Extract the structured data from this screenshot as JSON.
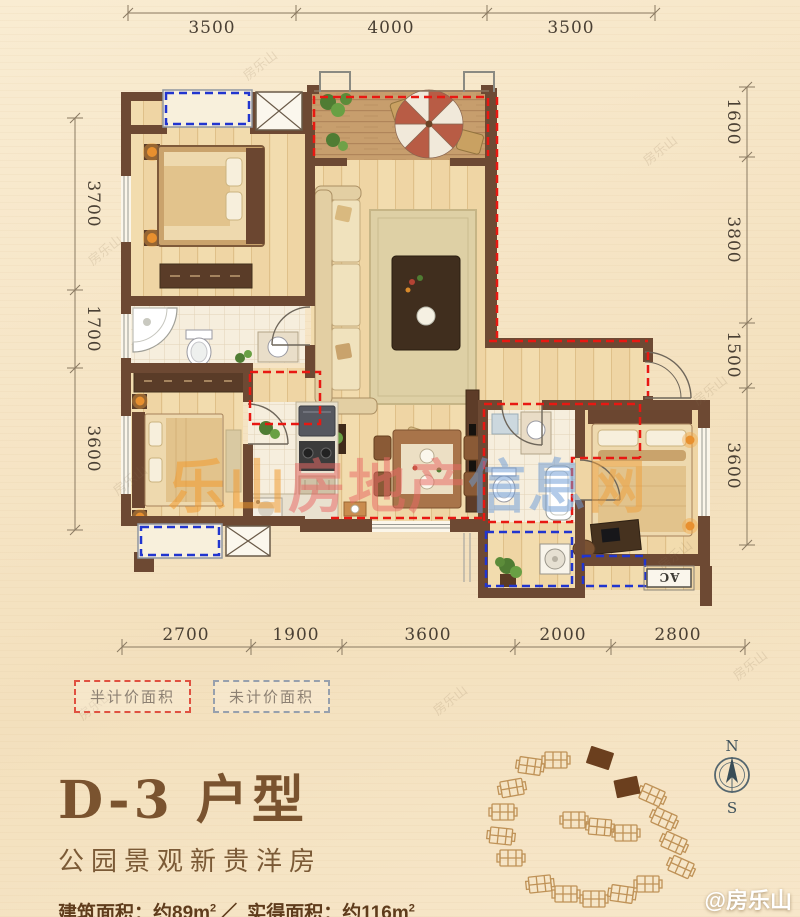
{
  "theme": {
    "background": "#f6e5c6",
    "wall_color": "#6d4933",
    "half_priced_dash": "#e81812",
    "unpriced_dash": "#2135cf",
    "title_brown": "#7a532f",
    "watermark_orange": "#f2992b",
    "watermark_red": "#e96a66",
    "watermark_blue": "#6f9dd6"
  },
  "dimensions": {
    "top": [
      "3500",
      "4000",
      "3500"
    ],
    "left": [
      "3700",
      "1700",
      "3600"
    ],
    "right": [
      "1600",
      "3800",
      "1500",
      "3600"
    ],
    "bottom": [
      "2700",
      "1900",
      "3600",
      "2000",
      "2800"
    ]
  },
  "legend": {
    "items": [
      {
        "label": "半计价面积"
      },
      {
        "label": "未计价面积"
      }
    ]
  },
  "plan": {
    "ac_label": "AC"
  },
  "compass": {
    "north": "N",
    "south": "S"
  },
  "watermark": {
    "center_parts": [
      {
        "text": "乐山"
      },
      {
        "text": "房地产"
      },
      {
        "text": "信息"
      },
      {
        "text": "网"
      }
    ],
    "tile": "房乐山",
    "corner": "@房乐山"
  },
  "title_block": {
    "title": "D-3 户型",
    "subtitle": "公园景观新贵洋房",
    "area": {
      "label_built": "建筑面积：",
      "value_built": "约89m",
      "sup": "2",
      "separator": "／",
      "label_actual": "实得面积：",
      "value_actual": "约116m"
    },
    "features": "全功能赠送、超高使用率、阔尺舒居、超低公摊"
  }
}
